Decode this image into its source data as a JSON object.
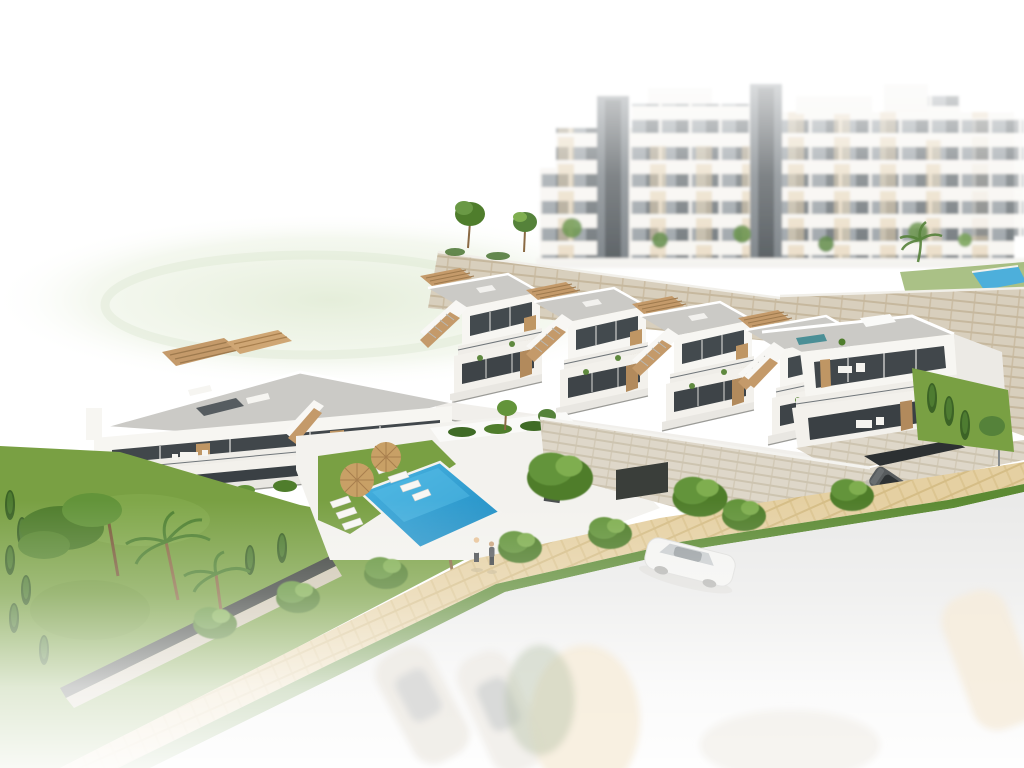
{
  "scene": {
    "type": "3d-architectural-rendering",
    "view": "aerial-three-quarter",
    "description": "New-build residential development render: a diagonal row of white townhouses with wooden accents, external stairs and roof terraces on a terraced hillside; large white apartment blocks fading into a white sky behind a stone retaining wall; a communal blue pool with lawn, straw parasols and white sun loungers; lush gardens with palms, pines and cypress hedges; a sandy footpath with two pedestrians; a driveway with a parked dark car and an underground garage; a road with a white car that fades to white at the bottom edge where ghost outlines of parked cars remain.",
    "elements": [
      "background-apartment-blocks",
      "stone-retaining-wall",
      "townhouse-row",
      "end-townhouse",
      "left-villa",
      "community-pool",
      "pool-lawn",
      "straw-umbrellas",
      "sun-loungers",
      "driveway",
      "garage-entrance",
      "parked-dark-car",
      "street-lamp",
      "background-pool",
      "garden",
      "pine-tree",
      "palm-trees",
      "cypress-trees",
      "slat-fence",
      "footpath",
      "hedge-strip",
      "road",
      "white-car",
      "pedestrians",
      "ghost-cars",
      "green-haze"
    ],
    "counts": {
      "row_townhouse_units": 5,
      "villa_units": 2,
      "straw_umbrellas": 2,
      "sun_loungers": 7,
      "pedestrians": 2,
      "cars_sharp": 2,
      "cars_ghosted": 3,
      "street_lamps": 1,
      "background_pools": 1
    }
  },
  "colors": {
    "background": "#ffffff",
    "facade_white": "#f6f5f1",
    "facade_shadow": "#edebe6",
    "glazing_dark": "#41474b",
    "glazing_deep": "#3a4044",
    "wood_tan": "#c49a6a",
    "wood_deep": "#a87f4e",
    "roof_deck": "#cbcac6",
    "stone_wall": "#d8cfbd",
    "stone_joint": "#c6b89e",
    "pool_blue": "#2b9fd4",
    "pool_deep": "#1985bf",
    "lawn_green": "#79a043",
    "tree_dark": "#4f7d2c",
    "tree_mid": "#63943a",
    "tree_light": "#7fae4f",
    "path_sand": "#e5d0a2",
    "path_joint": "#d5bd86",
    "hedge_green": "#5c8a33",
    "road_gray": "#eaeae9",
    "fence_dark": "#3a3e3a",
    "car_white": "#f4f4f2",
    "car_dark": "#585c5e",
    "umbrella_straw": "#c8a066",
    "metal_gray": "#868b8e",
    "bench_teal": "#4b8f96",
    "skin_tone": "#e8c49a"
  }
}
